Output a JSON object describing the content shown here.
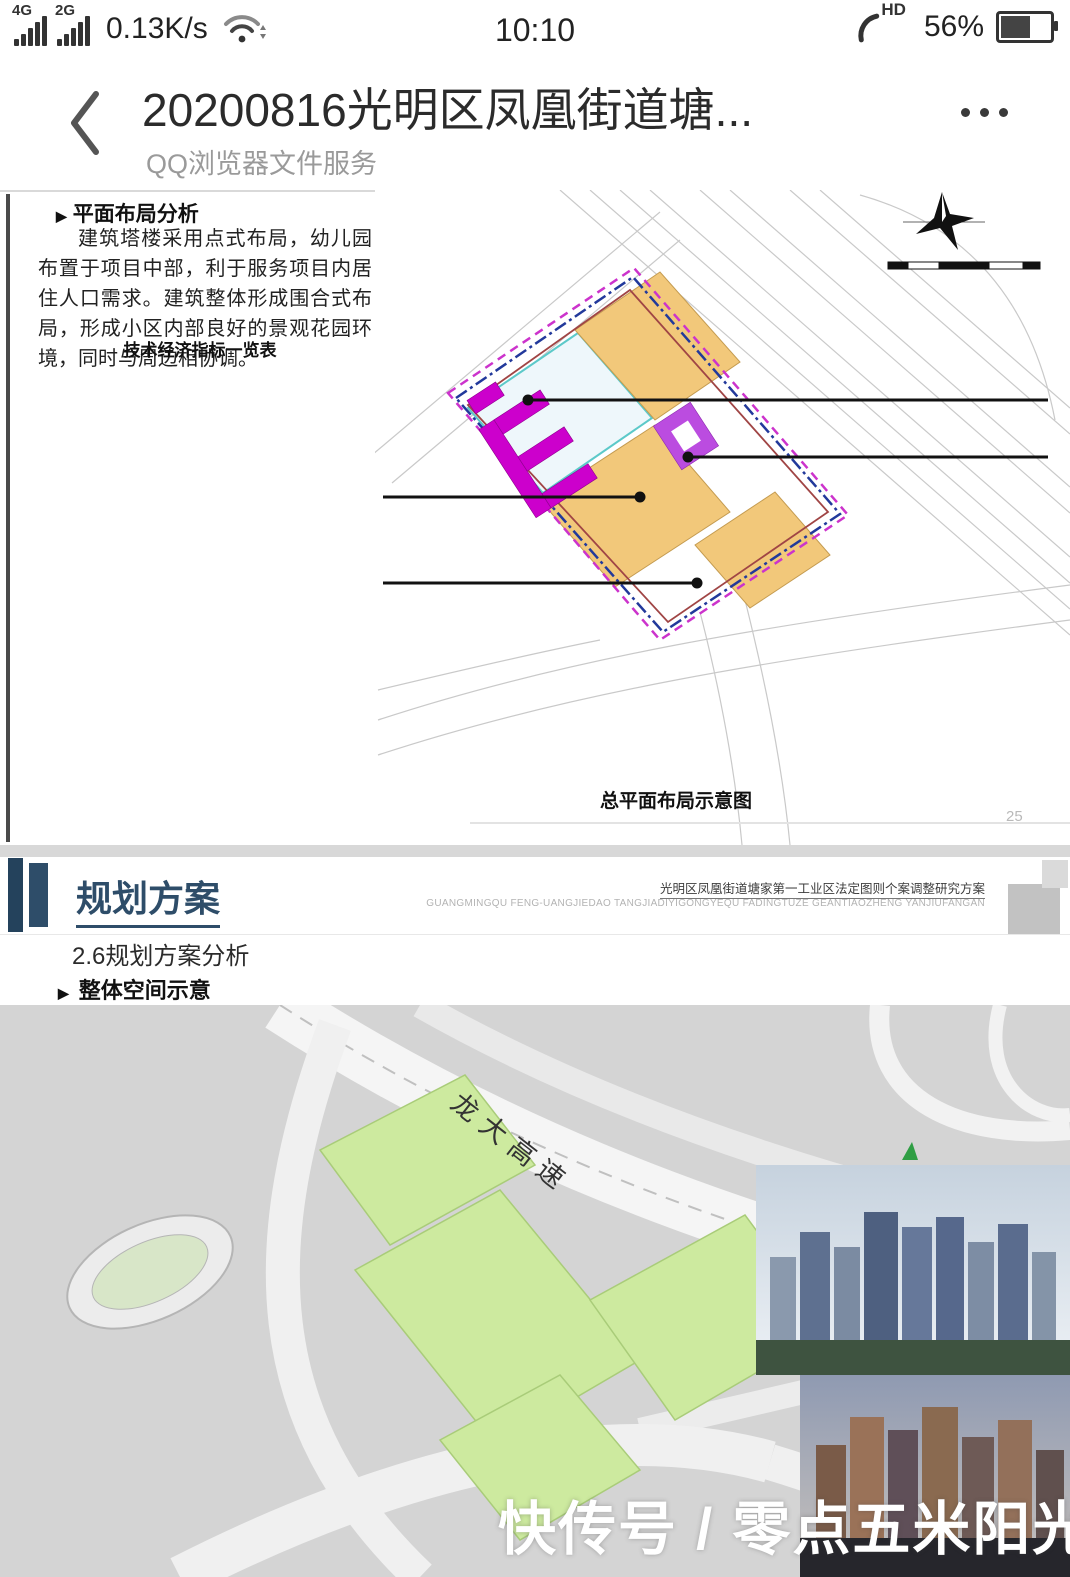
{
  "status_bar": {
    "network1": "4G",
    "network2": "2G",
    "speed": "0.13K/s",
    "time": "10:10",
    "hd_label": "HD",
    "battery_pct": "56%"
  },
  "nav": {
    "title": "20200816光明区凤凰街道塘...",
    "subtitle": "QQ浏览器文件服务"
  },
  "page1": {
    "heading_bullet": "▶",
    "heading": "平面布局分析",
    "paragraph": "建筑塔楼采用点式布局，幼儿园布置于项目中部，利于服务项目内居住人口需求。建筑整体形成围合式布局，形成小区内部良好的景观花园环境，同时与周边相协调。",
    "table_title": "技术经济指标一览表",
    "table": {
      "headers": [
        "项目",
        "数量"
      ],
      "span_outer": "其中",
      "span_inner": "其中",
      "rows": [
        {
          "label": "开发建设用地面积 (m²)",
          "value": "61173.2"
        },
        {
          "label": "规划容积率",
          "value": "5.5"
        },
        {
          "label": "规划容积",
          "value": "336792"
        },
        {
          "label": "住宅",
          "value": "311452"
        },
        {
          "label": "商业",
          "value": "10000"
        },
        {
          "label": "公共配套设施",
          "value": "15340"
        },
        {
          "label": "社区警务室",
          "value": "50"
        },
        {
          "label": "社区管理用房",
          "value": "300"
        },
        {
          "label": "社区服务中心",
          "value": "400"
        },
        {
          "label": "18班幼儿园",
          "value": [
            "4800",
            "(占地5400)"
          ]
        },
        {
          "label": "文化活动室",
          "value": "1000"
        },
        {
          "label": "社区健康服务中心",
          "value": "1000"
        },
        {
          "label": "社区老年人日间照料中心",
          "value": "750"
        },
        {
          "label": "公交首末站",
          "value": "4300"
        },
        {
          "label": "公共充电站",
          "value": "700"
        },
        {
          "label": "小型垃圾转运站（含再生资源回收站、公共厕所和环卫工人作息房）",
          "value": "480"
        },
        {
          "label": "社区级公共配套用房",
          "value": "1750"
        }
      ]
    },
    "annotations": [
      {
        "id": "a1",
        "lines": [
          "住宅  40F",
          "标准层570㎡",
          "H=120m"
        ]
      },
      {
        "id": "a2",
        "lines": [
          "安居型商品房",
          "33F",
          "标准层1007㎡",
          "H=100m"
        ]
      },
      {
        "id": "a3",
        "lines": [
          "27班九年一贯学校",
          "H=20m"
        ]
      },
      {
        "id": "a4",
        "lines": [
          "18班幼儿园",
          "H=12m"
        ]
      }
    ],
    "legend": [
      {
        "type": "dash-magenta",
        "label": "更新单元范围线"
      },
      {
        "type": "dashdot-navy",
        "label": "拆除范围线"
      },
      {
        "type": "solid-red",
        "label": "开发建设用地范围线"
      },
      {
        "type": "solid-cyan",
        "label": "独立占地的公共服务设施及其它\n移交给政府的独立用地范围线"
      },
      {
        "type": "box-magenta",
        "label": "人行出入口"
      },
      {
        "type": "box-blue",
        "label": "车行出入口"
      },
      {
        "type": "box-green",
        "label": "公交首末站出入口"
      }
    ],
    "road_labels": [
      "龙大高速",
      "科能路",
      "公路",
      "鹅径东路",
      "侨光布路",
      "二十号路",
      "规划",
      "号路",
      "四"
    ],
    "scale_labels": [
      "0",
      "20",
      "50",
      "100",
      "150m"
    ],
    "caption": "总平面布局示意图",
    "page_number": "25"
  },
  "page2": {
    "section_title": "规划方案",
    "doc_title_cn": "光明区凤凰街道塘家第一工业区法定图则个案调整研究方案",
    "doc_title_en": "GUANGMINGQU FENG-UANGJIEDAO TANGJIADIYIGONGYEQU FADINGTUZE GEANTIAOZHENG YANJIUFANGAN",
    "sub_heading": "2.6规划方案分析",
    "bullet_char": "▶",
    "bullet_heading": "整体空间示意",
    "labels_3d": [
      "100m",
      "100m",
      "120m",
      "120m",
      "100m",
      "100m",
      "120m",
      "100m"
    ],
    "road_main": "龙大高速",
    "road_secondary": "侨路",
    "watermark": "快传号 / 零点五米阳光"
  },
  "colors": {
    "accent_navy": "#2e4d69",
    "value_red": "#d42a22",
    "magenta_building": "#cc00cc",
    "yellow_building": "#f3ee1e",
    "orange_parcel": "#f2c87a",
    "purple_kindergarten": "#bb4ce0",
    "green_parcel_3d": "#cdea9f"
  }
}
